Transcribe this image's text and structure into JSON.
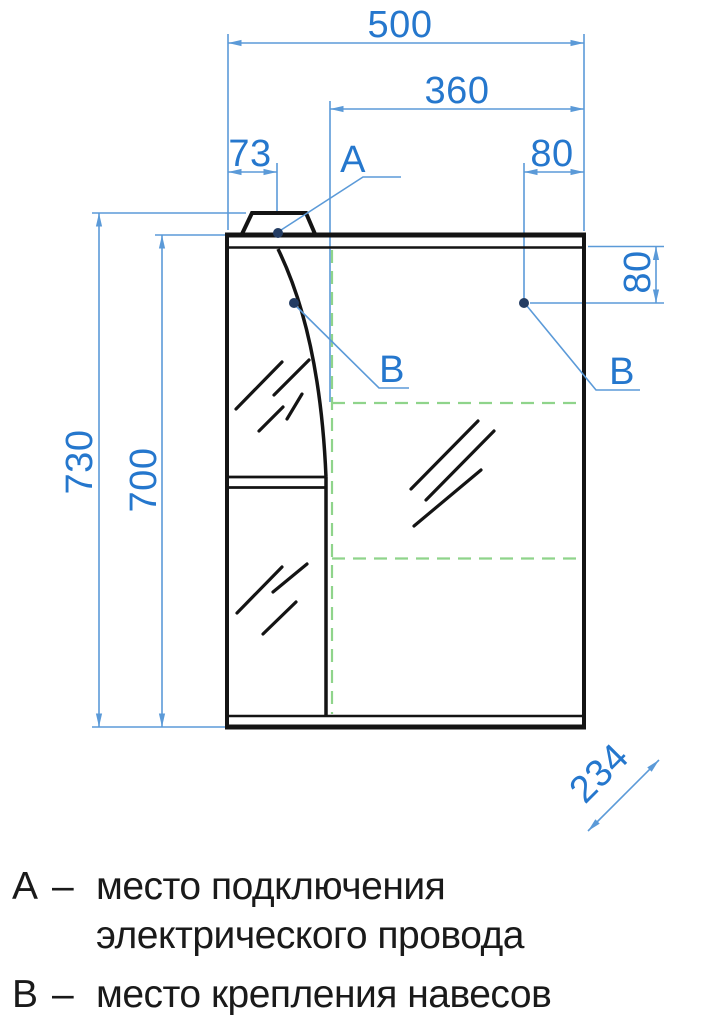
{
  "drawing": {
    "dimensions": {
      "width_total": "500",
      "width_mirror_door": "360",
      "cap_offset_left": "73",
      "hinge_offset_top_right": "80",
      "hinge_offset_side_right": "80",
      "height_total": "730",
      "height_body": "700",
      "depth": "234"
    },
    "markers": {
      "point_a": "А",
      "point_b_left": "В",
      "point_b_right": "В"
    },
    "colors": {
      "dimension_blue": "#2577cd",
      "dimension_line_blue": "#5b9ad8",
      "hidden_line_green": "#8fd48b",
      "outline_black": "#141414",
      "marker_dot_navy": "#233c63"
    }
  },
  "legend": {
    "items": [
      {
        "key": "А",
        "separator": "–",
        "description": "место подключения электрического провода"
      },
      {
        "key": "В",
        "separator": "–",
        "description": "место крепления навесов"
      }
    ]
  }
}
